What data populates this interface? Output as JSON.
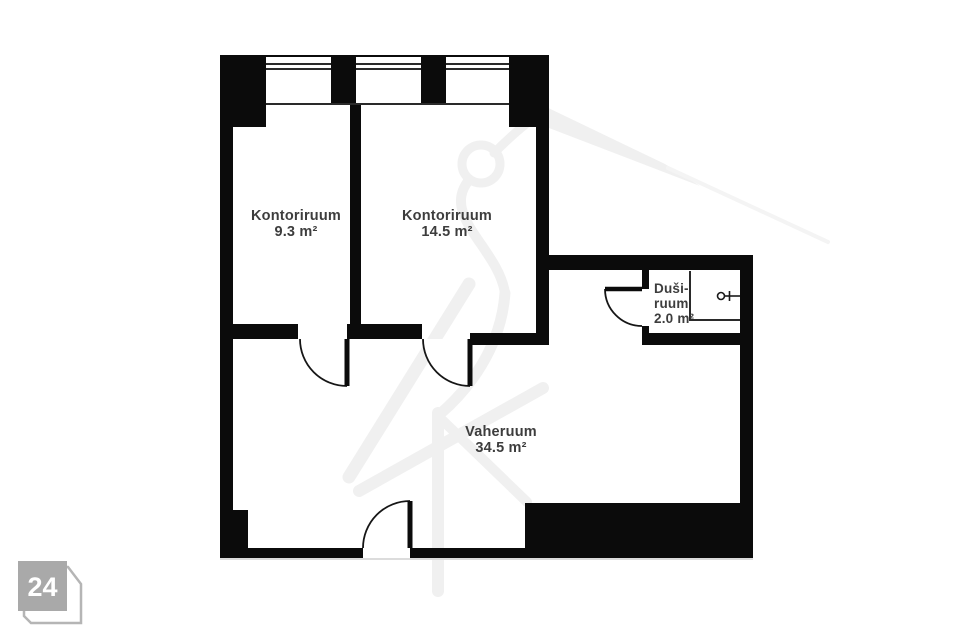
{
  "floorplan": {
    "rooms": [
      {
        "name": "Kontoriruum",
        "area": "9.3 m²"
      },
      {
        "name": "Kontoriruum",
        "area": "14.5 m²"
      },
      {
        "name_line1": "Duši-",
        "name_line2": "ruum",
        "area": "2.0 m²"
      },
      {
        "name": "Vaheruum",
        "area": "34.5 m²"
      }
    ],
    "colors": {
      "wall": "#0b0b0b",
      "thin_line": "#2a2a2a",
      "room_text": "#3d3d3d",
      "watermark": "#f0f0f0",
      "floor": "#ffffff"
    }
  },
  "badge": {
    "number": "24",
    "square_fill": "#a9a9a9",
    "outline_stroke": "#b5b5b5",
    "text_color": "#ffffff"
  }
}
